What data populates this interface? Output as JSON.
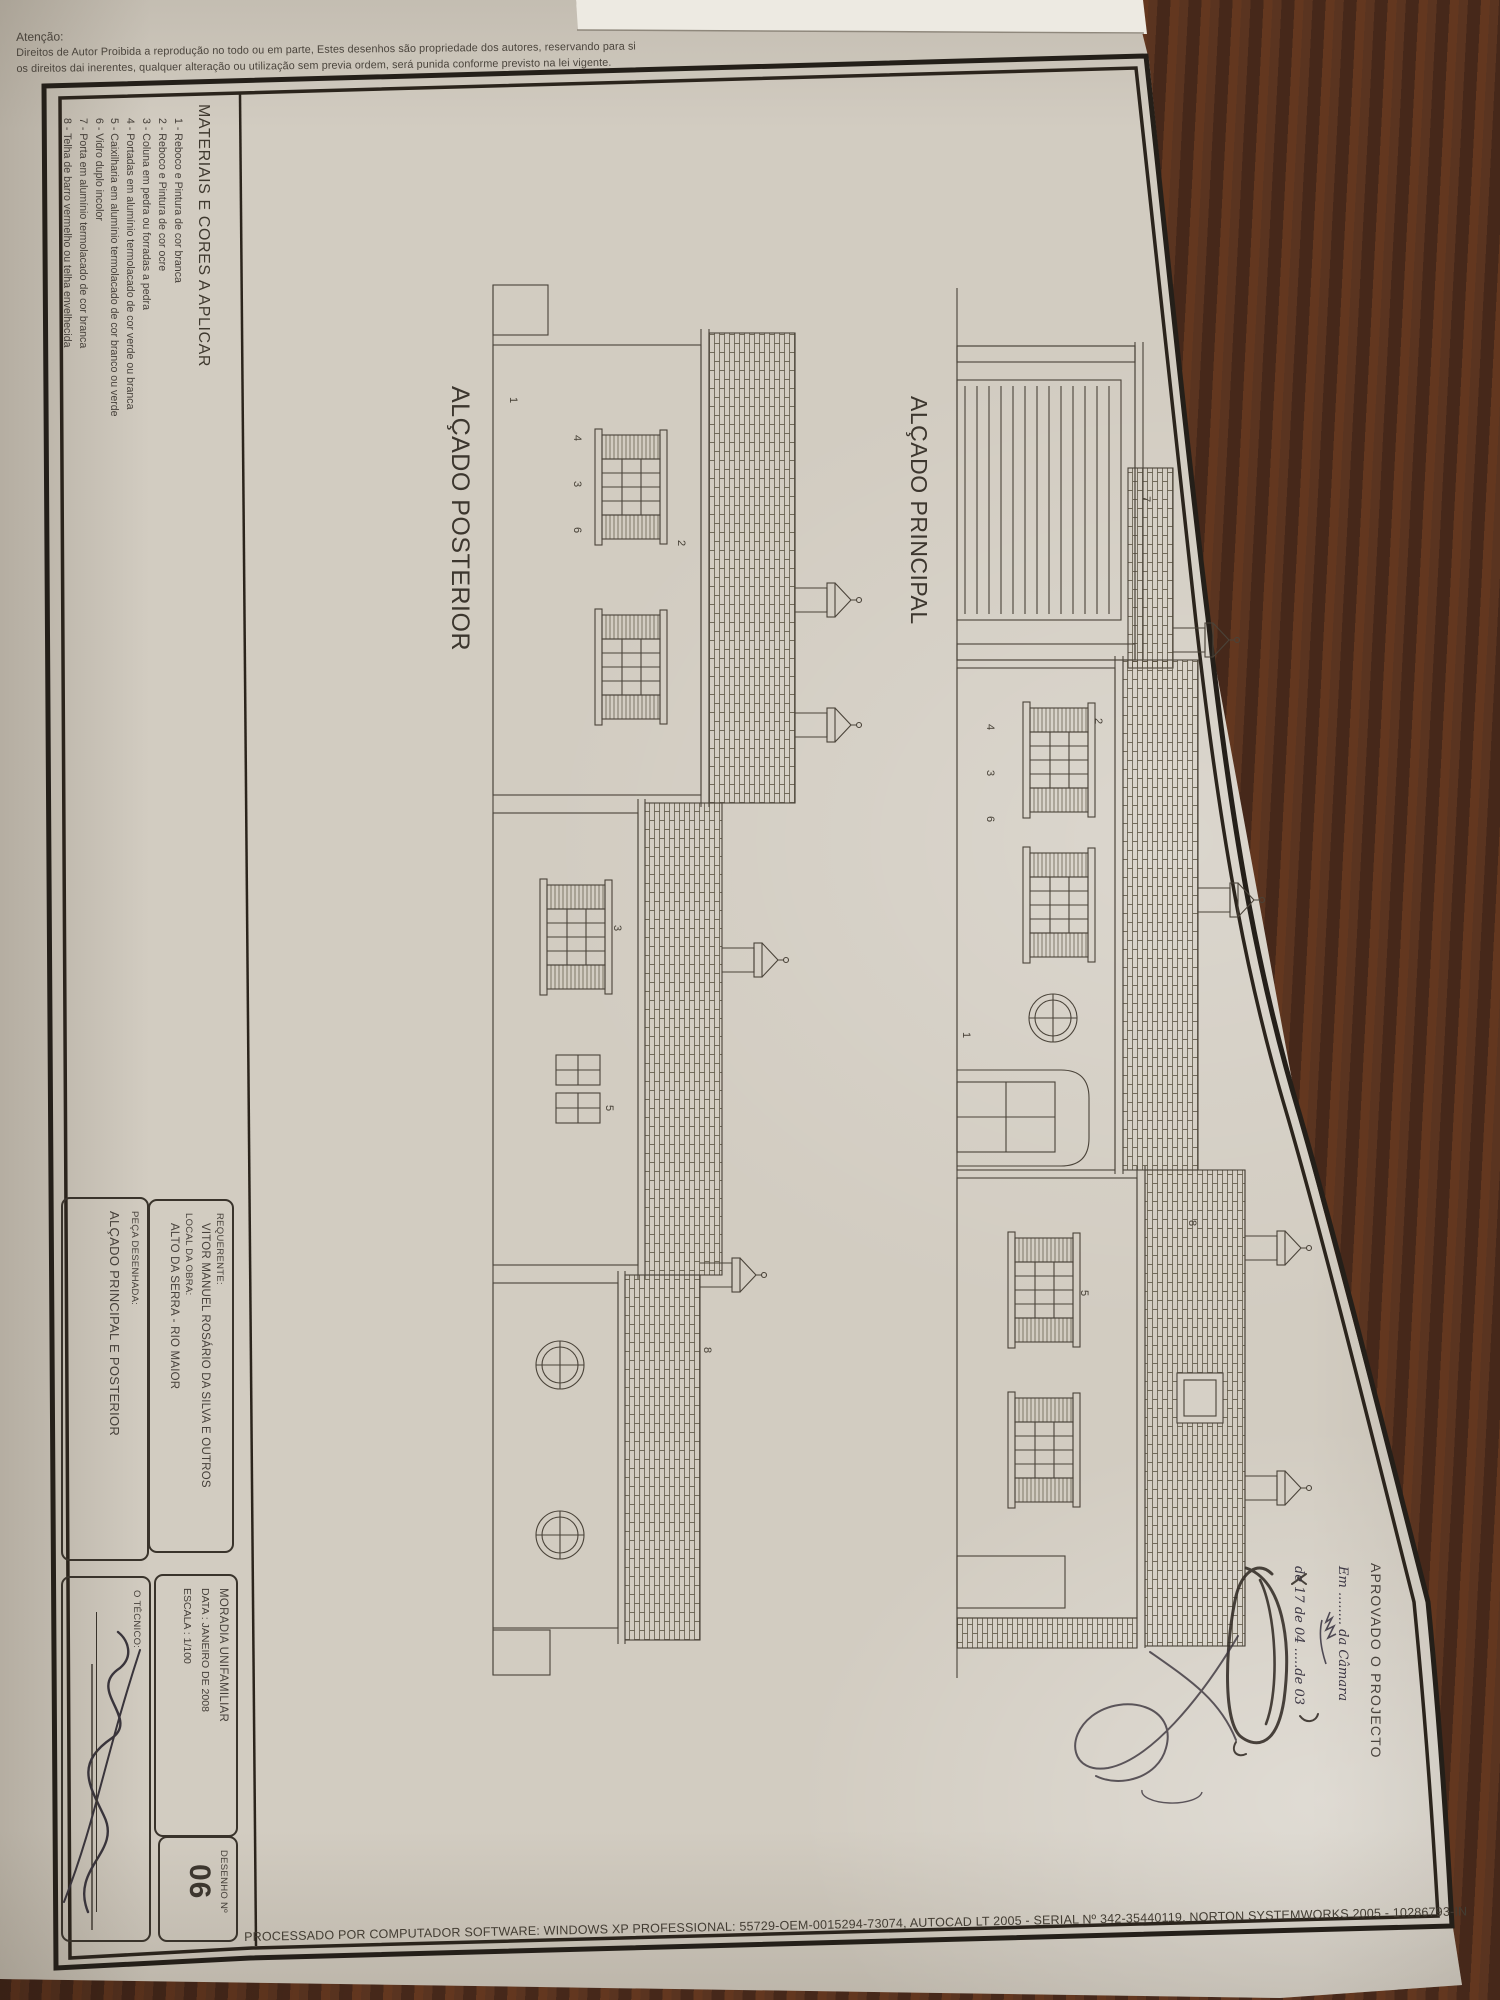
{
  "copyright_note": {
    "heading": "Atenção:",
    "line1": "Direitos de Autor Proibida a reprodução no todo ou em parte, Estes desenhos são propriedade dos autores, reservando para si",
    "line2": "os direitos dai inerentes, qualquer alteração ou utilização sem previa ordem, será punida conforme previsto na lei vigente."
  },
  "materials_legend": {
    "title": "MATERIAIS E CORES A APLICAR",
    "items": [
      "1 - Reboco e Pintura de cor branca",
      "2 - Reboco e Pintura de cor ocre",
      "3 - Coluna em pedra ou forradas a pedra",
      "4 - Portadas em alumínio termolacado de cor verde ou branca",
      "5 - Caixilharia em alumínio termolacado de cor branco ou verde",
      "6 - Vidro duplo incolor",
      "7 - Porta em alumínio termolacado de cor branca",
      "8 - Telha de barro vermelho ou telha envelhecida"
    ]
  },
  "drawings": {
    "posterior": {
      "title": "ALÇADO POSTERIOR",
      "labels": [
        "2",
        "4",
        "3",
        "6",
        "1",
        "3",
        "5",
        "8"
      ]
    },
    "principal": {
      "title": "ALÇADO PRINCIPAL",
      "labels": [
        "7",
        "2",
        "4",
        "3",
        "6",
        "1",
        "5",
        "8"
      ]
    }
  },
  "title_block": {
    "requerente_label": "REQUERENTE:",
    "requerente_value": "VITOR MANUEL ROSÁRIO DA SILVA E OUTROS",
    "local_label": "LOCAL DA OBRA:",
    "local_value": "ALTO DA SERRA - RIO MAIOR",
    "peca_label": "PEÇA DESENHADA:",
    "peca_value": "ALÇADO PRINCIPAL E POSTERIOR",
    "tecnico_label": "O TÉCNICO:",
    "moradia": "MORADIA UNIFAMILIAR",
    "data": "DATA : JANEIRO DE 2008",
    "escala": "ESCALA : 1/100",
    "desenho_label": "DESENHO  Nº",
    "desenho_num": "06"
  },
  "approval_stamp": {
    "title": "APROVADO O PROJECTO",
    "hand_line1": "Em ........ da Câmara",
    "hand_line2": "de 17 de 04 .....de 03"
  },
  "footer": {
    "processed": "PROCESSADO POR COMPUTADOR SOFTWARE: WINDOWS XP PROFESSIONAL:  55729-OEM-0015294-73074, AUTOCAD LT 2005 - SERIAL Nº  342-35440119, NORTON SYSTEMWORKS 2005 - 10286793-IN"
  },
  "colors": {
    "paper": "#d2ccc1",
    "ink": "#46403a",
    "frame": "#241f19",
    "wood": "#4a2a18",
    "pen_ink": "#3c3744"
  }
}
